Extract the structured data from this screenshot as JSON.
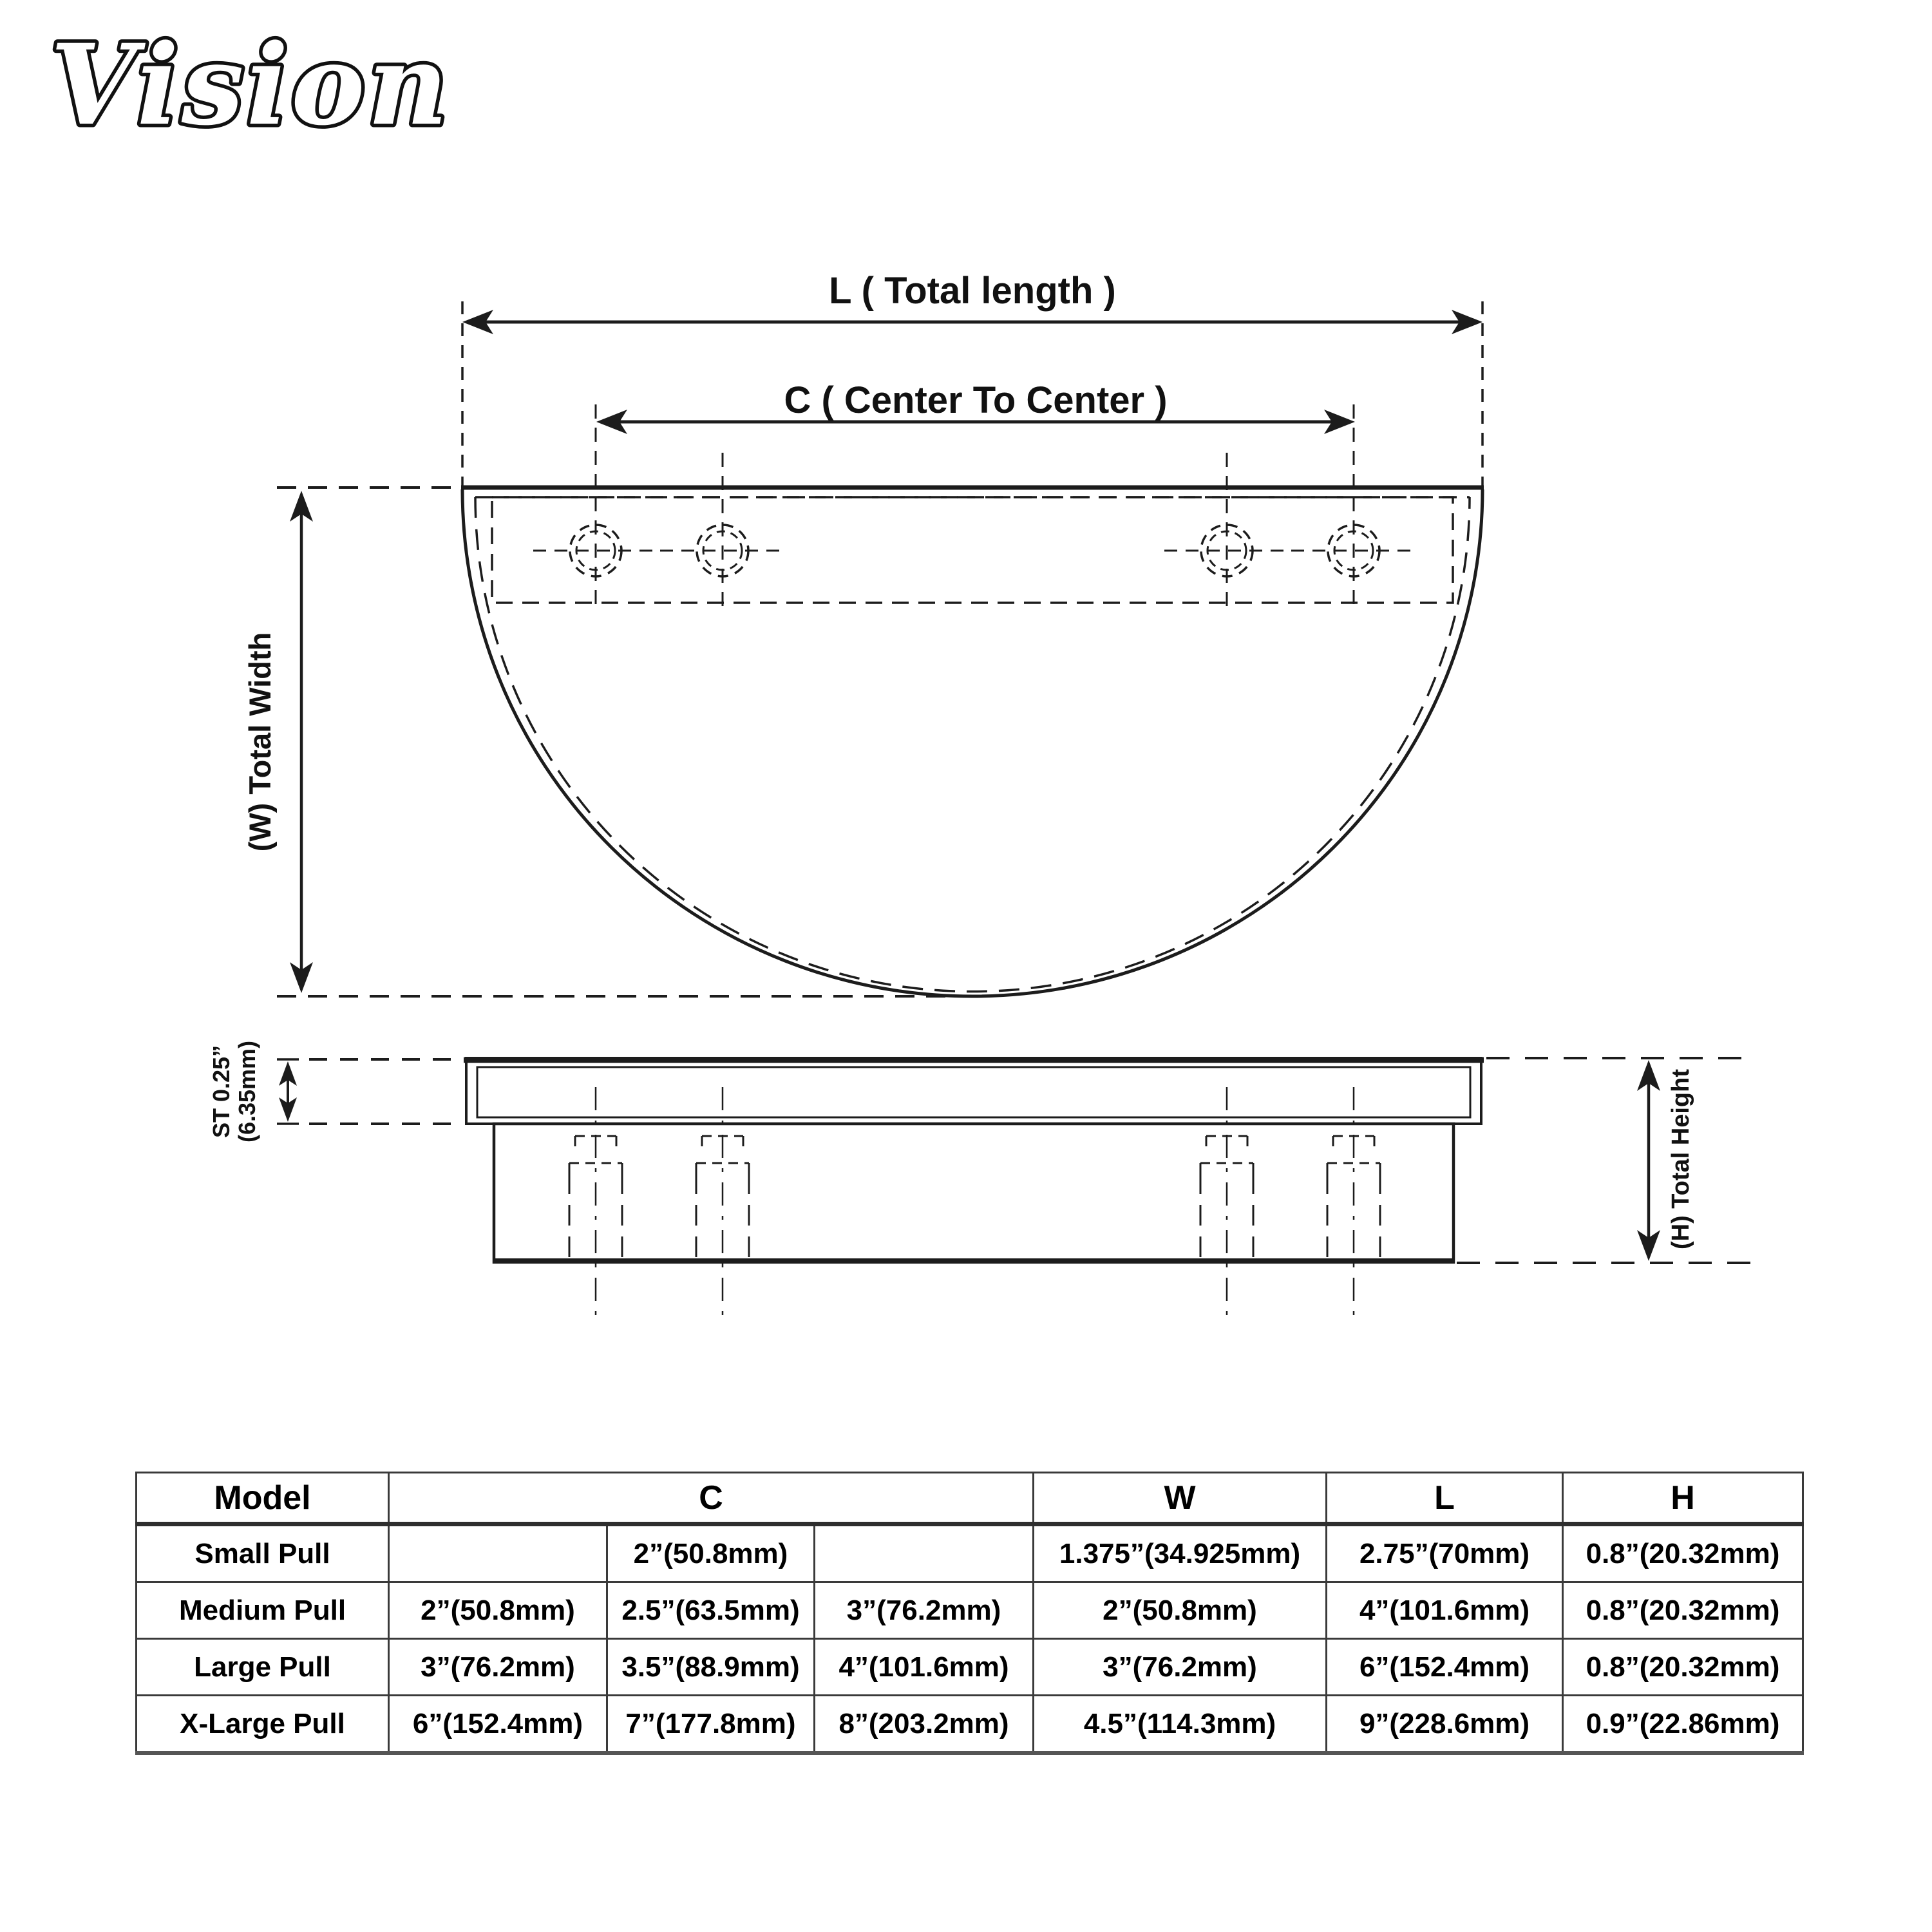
{
  "logo": "Vision",
  "front_view": {
    "dim_L_label": "L ( Total length )",
    "dim_C_label": "C ( Center To Center )",
    "dim_W_label": "(W) Total Width"
  },
  "side_view": {
    "dim_ST_label_line1": "ST 0.25”",
    "dim_ST_label_line2": "(6.35mm)",
    "dim_H_label": "(H) Total Height"
  },
  "table": {
    "headers": {
      "model": "Model",
      "c": "C",
      "w": "W",
      "l": "L",
      "h": "H"
    },
    "rows": [
      {
        "model": "Small Pull",
        "c1": "",
        "c2": "2”(50.8mm)",
        "c3": "",
        "w": "1.375”(34.925mm)",
        "l": "2.75”(70mm)",
        "h": "0.8”(20.32mm)"
      },
      {
        "model": "Medium Pull",
        "c1": "2”(50.8mm)",
        "c2": "2.5”(63.5mm)",
        "c3": "3”(76.2mm)",
        "w": "2”(50.8mm)",
        "l": "4”(101.6mm)",
        "h": "0.8”(20.32mm)"
      },
      {
        "model": "Large Pull",
        "c1": "3”(76.2mm)",
        "c2": "3.5”(88.9mm)",
        "c3": "4”(101.6mm)",
        "w": "3”(76.2mm)",
        "l": "6”(152.4mm)",
        "h": "0.8”(20.32mm)"
      },
      {
        "model": "X-Large Pull",
        "c1": "6”(152.4mm)",
        "c2": "7”(177.8mm)",
        "c3": "8”(203.2mm)",
        "w": "4.5”(114.3mm)",
        "l": "9”(228.6mm)",
        "h": "0.9”(22.86mm)"
      }
    ]
  },
  "colors": {
    "line": "#1c1c1c",
    "background": "#ffffff"
  }
}
